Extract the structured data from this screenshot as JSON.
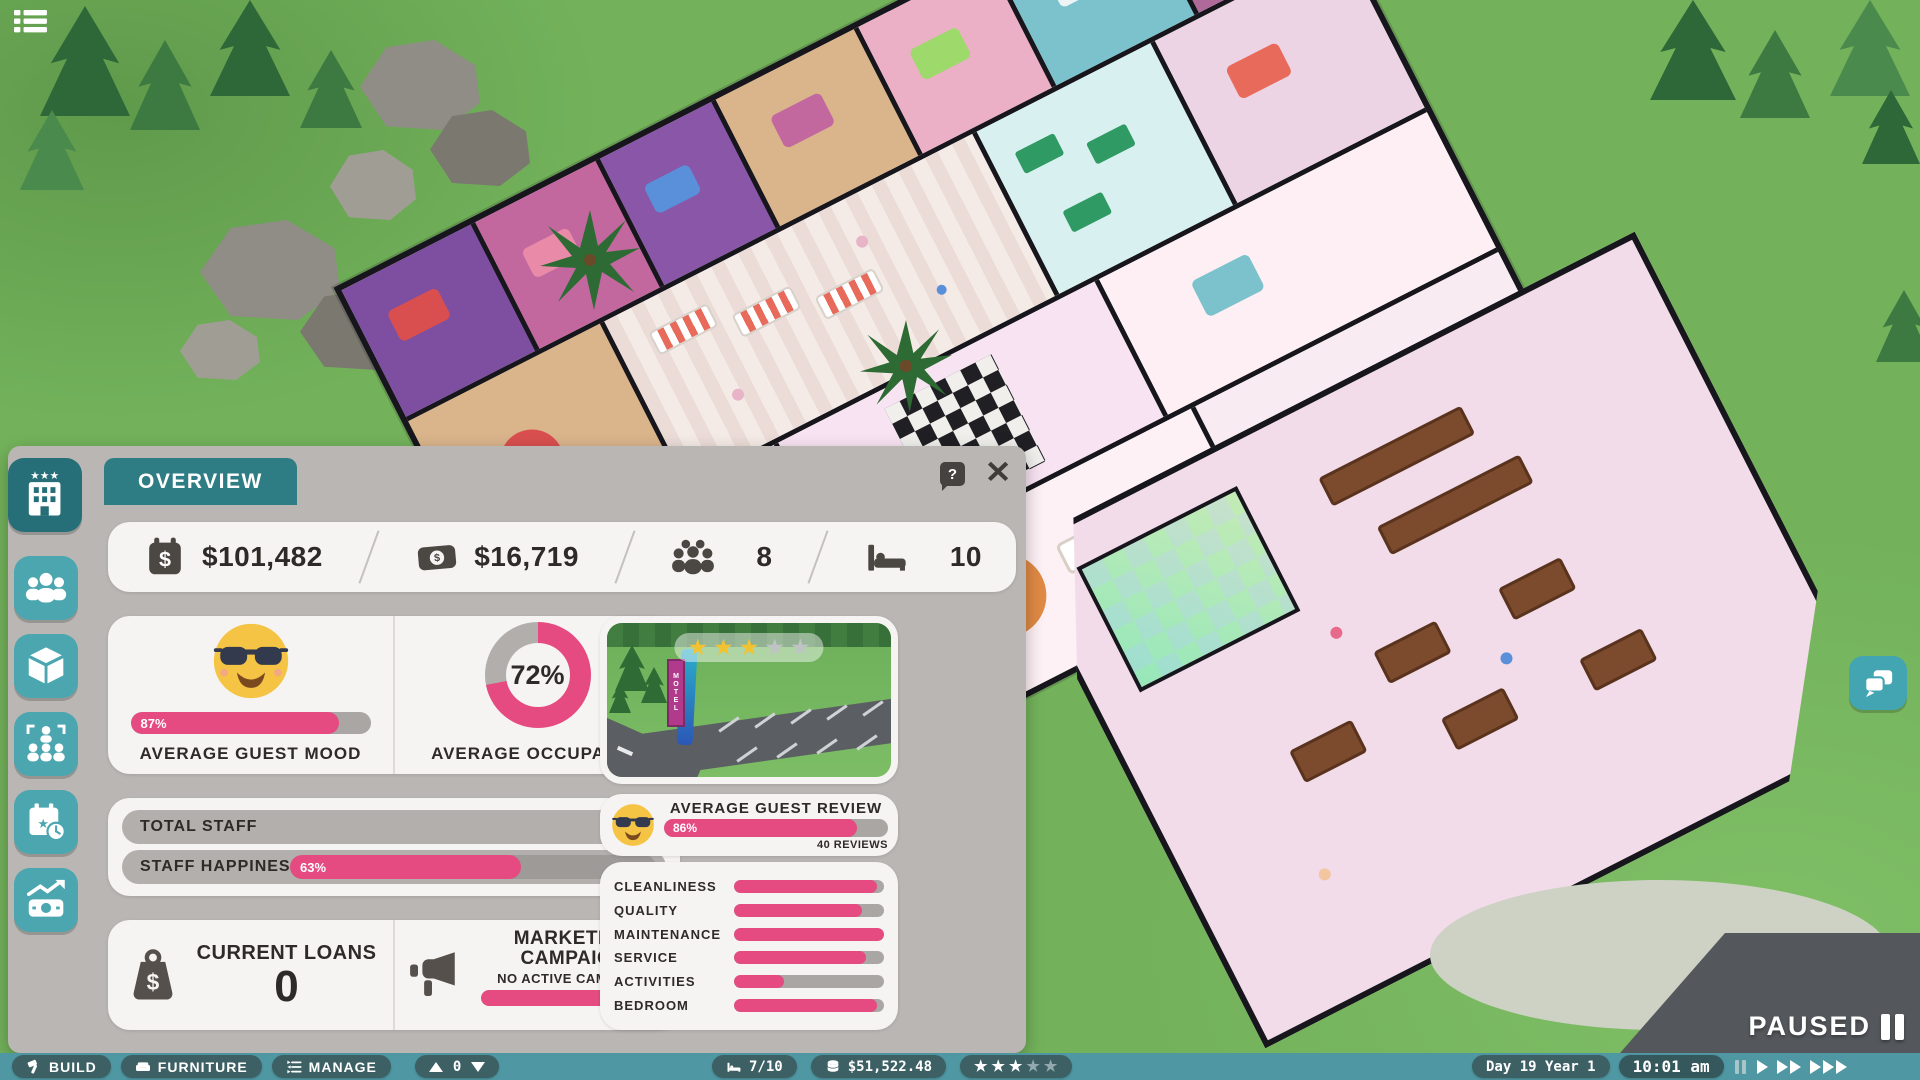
{
  "colors": {
    "accent_pink": "#e54a81",
    "bar_track": "#a9a6a4",
    "tab_teal": "#2e7d85",
    "toolbar_teal": "#4f97a2",
    "sidebar_teal": "#4ba6b0",
    "sidebar_active_teal": "#276f78"
  },
  "sidebar": {
    "items": [
      {
        "id": "hotel",
        "icon": "hotel-building-icon",
        "active": true
      },
      {
        "id": "guests",
        "icon": "guests-icon",
        "active": false
      },
      {
        "id": "rooms",
        "icon": "room-box-icon",
        "active": false
      },
      {
        "id": "staff",
        "icon": "staff-icon",
        "active": false
      },
      {
        "id": "schedule",
        "icon": "calendar-clock-icon",
        "active": false
      },
      {
        "id": "finance",
        "icon": "money-trend-icon",
        "active": false
      }
    ]
  },
  "overview": {
    "tab": "OVERVIEW",
    "help_icon": "?",
    "stats": {
      "balance": {
        "icon": "calendar-dollar-icon",
        "value": "$101,482"
      },
      "income": {
        "icon": "cash-icon",
        "value": "$16,719"
      },
      "guests": {
        "icon": "guest-group-icon",
        "value": "8"
      },
      "beds": {
        "icon": "bed-icon",
        "value": "10"
      }
    },
    "guest_mood": {
      "label": "AVERAGE GUEST MOOD",
      "percent": 87,
      "percent_text": "87%",
      "emoji": "sunglasses-smiley"
    },
    "occupancy": {
      "label": "AVERAGE OCCUPANCY",
      "percent": 72,
      "percent_text": "72%"
    },
    "total_staff": {
      "label": "TOTAL STAFF",
      "value": "9"
    },
    "staff_happiness": {
      "label": "STAFF HAPPINESS",
      "percent": 63,
      "percent_text": "63%"
    },
    "current_loans": {
      "label": "CURRENT LOANS",
      "value": "0",
      "icon": "loan-weight-icon"
    },
    "marketing": {
      "title": "MARKETING CAMPAIGN",
      "status": "NO ACTIVE CAMPAIGN",
      "bar_percent": 100,
      "time_left_label": "TIME LEFT",
      "icon": "megaphone-icon"
    },
    "preview": {
      "stars": 3,
      "stars_total": 5,
      "sign_text": "MOTEL"
    },
    "review": {
      "label": "AVERAGE GUEST REVIEW",
      "percent": 86,
      "percent_text": "86%",
      "reviews": "40 REVIEWS",
      "emoji": "sunglasses-smiley"
    },
    "categories": [
      {
        "label": "CLEANLINESS",
        "percent": 95
      },
      {
        "label": "QUALITY",
        "percent": 85
      },
      {
        "label": "MAINTENANCE",
        "percent": 100
      },
      {
        "label": "SERVICE",
        "percent": 88
      },
      {
        "label": "ACTIVITIES",
        "percent": 33
      },
      {
        "label": "BEDROOM",
        "percent": 95
      }
    ]
  },
  "bottom_bar": {
    "build": "BUILD",
    "furniture": "FURNITURE",
    "manage": "MANAGE",
    "floor": {
      "value": "0"
    },
    "rooms": {
      "value": "7/10",
      "icon": "bed-icon"
    },
    "money": {
      "value": "$51,522.48",
      "icon": "coins-icon"
    },
    "rating": {
      "stars": 3,
      "total": 5
    },
    "date": "Day 19 Year 1",
    "time": "10:01 am"
  },
  "status": {
    "paused_label": "PAUSED"
  }
}
